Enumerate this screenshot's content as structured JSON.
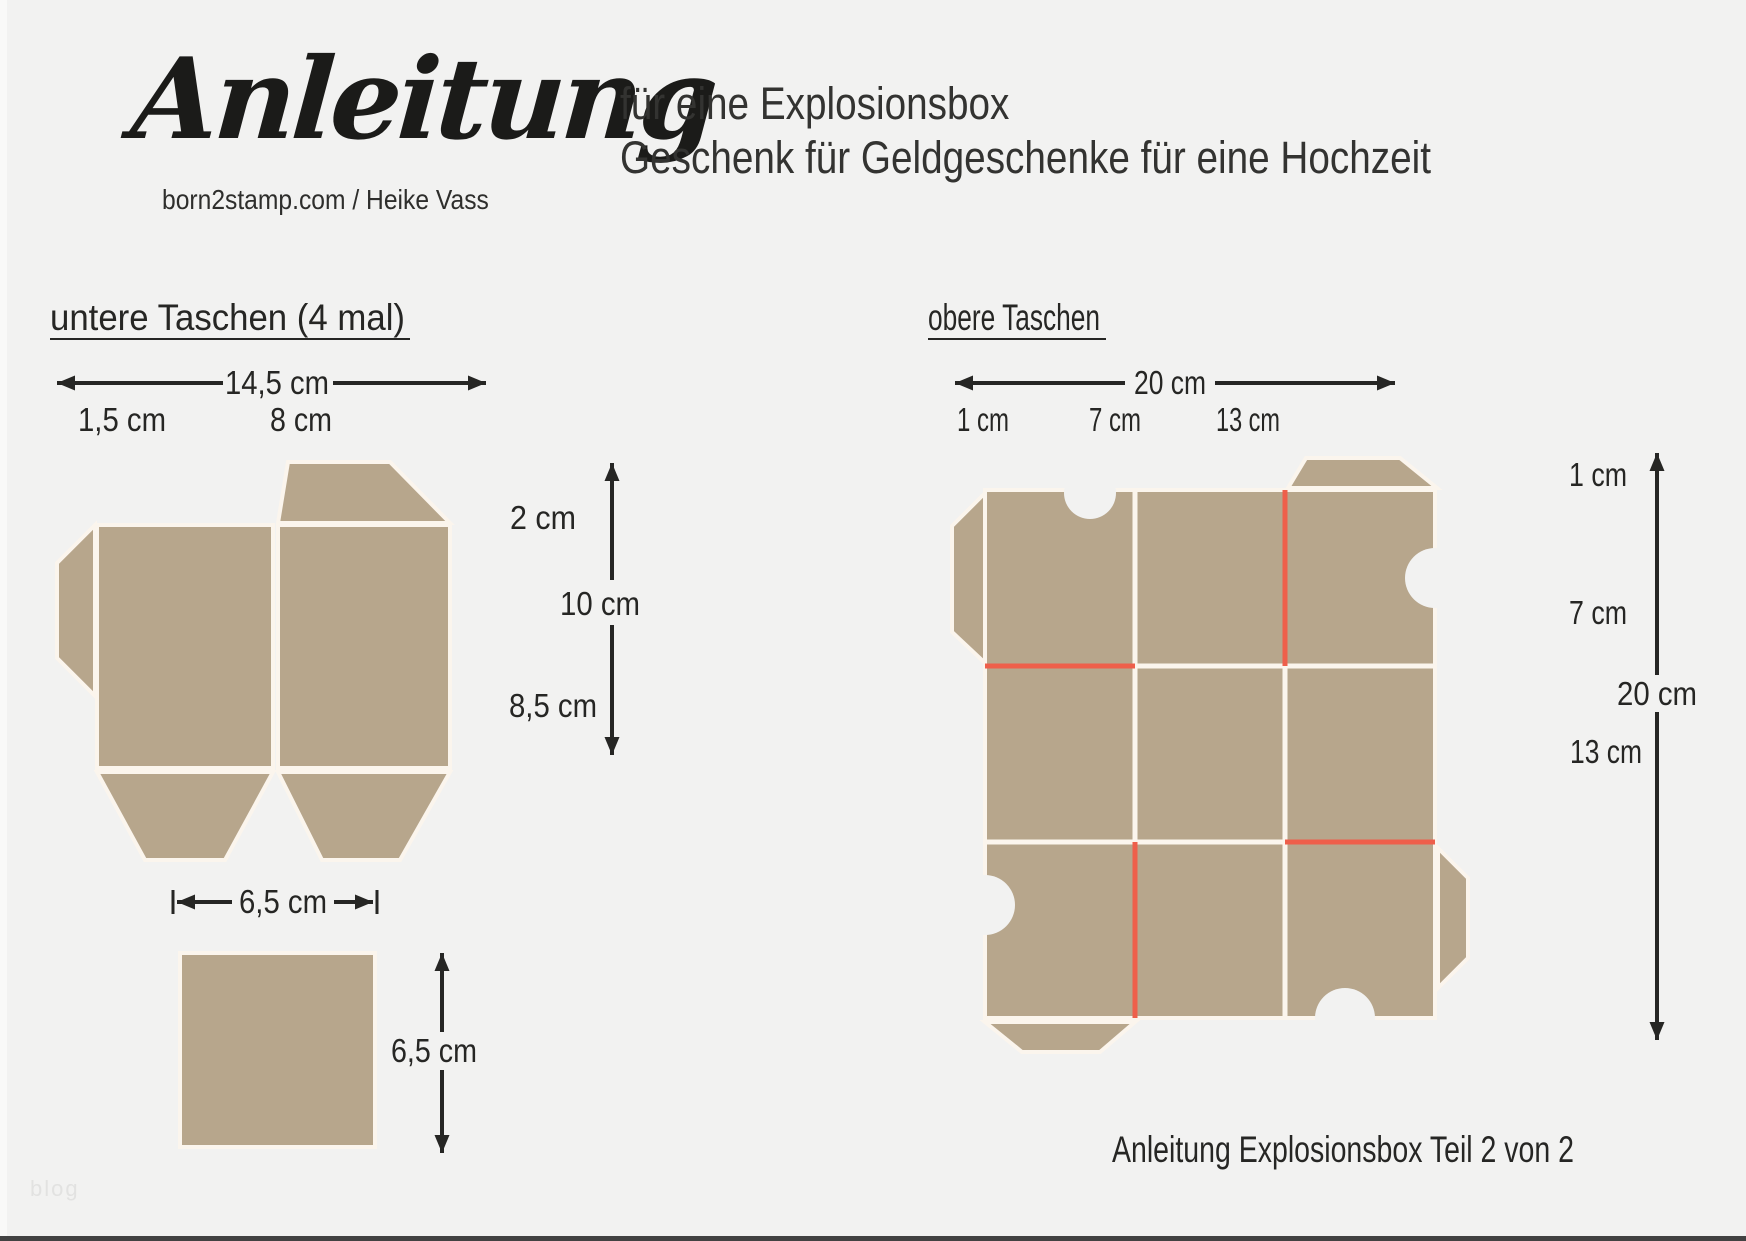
{
  "header": {
    "title": "Anleitung",
    "byline": "born2stamp.com / Heike Vass",
    "subtitle_line1": "für eine Explosionsbox",
    "subtitle_line2": "Geschenk für Geldgeschenke für eine Hochzeit"
  },
  "left_section": {
    "heading": "untere Taschen (4 mal)",
    "width_total": "14,5 cm",
    "width_mark_1": "1,5 cm",
    "width_mark_2": "8 cm",
    "height_mark_top": "2 cm",
    "height_total": "10 cm",
    "height_mark_bottom": "8,5 cm"
  },
  "small_square": {
    "width_label": "6,5 cm",
    "height_label": "6,5 cm"
  },
  "right_section": {
    "heading": "obere Taschen",
    "width_total": "20 cm",
    "width_mark_1": "1 cm",
    "width_mark_2": "7 cm",
    "width_mark_3": "13 cm",
    "height_mark_1": "1 cm",
    "height_mark_2": "7 cm",
    "height_total": "20 cm",
    "height_mark_3": "13 cm"
  },
  "footer": {
    "caption": "Anleitung Explosionsbox Teil 2 von 2",
    "watermark": "blog"
  },
  "colors": {
    "background": "#f2f2f1",
    "cardboard_tan": "#b7a68c",
    "score_line_white": "#fbf5ed",
    "cut_line_red": "#ee5f4b",
    "ink": "#262624",
    "footer_bar": "#424242"
  }
}
